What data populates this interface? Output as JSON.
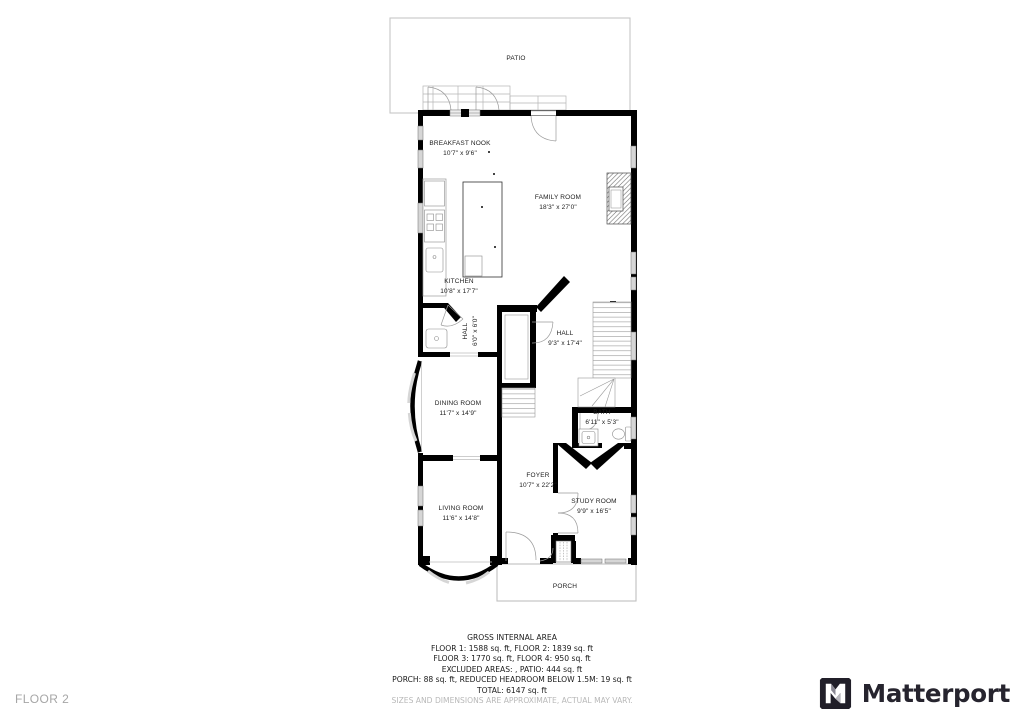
{
  "floor_label": "FLOOR 2",
  "brand": {
    "name": "Matterport"
  },
  "icons": {
    "matterport": "folded-m-mark"
  },
  "colors": {
    "walls": "#000000",
    "window_fill": "#d6d6d6",
    "patio_outline": "#c6c6c6",
    "brand_dark": "#26242e",
    "muted_text": "#a6a6a6"
  },
  "rooms": [
    {
      "name": "PATIO",
      "dims": ""
    },
    {
      "name": "BREAKFAST NOOK",
      "dims": "10'7\" x 9'6\""
    },
    {
      "name": "FAMILY ROOM",
      "dims": "18'3\" x 27'0\""
    },
    {
      "name": "KITCHEN",
      "dims": "10'8\" x 17'7\""
    },
    {
      "name": "HALL",
      "dims": "6'0\" x 6'0\""
    },
    {
      "name": "HALL",
      "dims": "9'3\" x 17'4\""
    },
    {
      "name": "DINING ROOM",
      "dims": "11'7\" x 14'9\""
    },
    {
      "name": "BATH",
      "dims": "6'11\" x 5'3\""
    },
    {
      "name": "FOYER",
      "dims": "10'7\" x 22'2\""
    },
    {
      "name": "LIVING ROOM",
      "dims": "11'6\" x 14'8\""
    },
    {
      "name": "STUDY ROOM",
      "dims": "9'9\" x 16'5\""
    },
    {
      "name": "PORCH",
      "dims": ""
    }
  ],
  "summary": {
    "title": "GROSS INTERNAL AREA",
    "lines": [
      "FLOOR 1: 1588 sq. ft, FLOOR 2: 1839 sq. ft",
      "FLOOR 3: 1770 sq. ft, FLOOR 4: 950 sq. ft",
      "EXCLUDED AREAS: , PATIO: 444 sq. ft",
      "PORCH: 88 sq. ft, REDUCED HEADROOM BELOW 1.5M: 19 sq. ft",
      "TOTAL: 6147 sq. ft"
    ],
    "disclaimer": "SIZES AND DIMENSIONS ARE APPROXIMATE, ACTUAL MAY VARY."
  }
}
